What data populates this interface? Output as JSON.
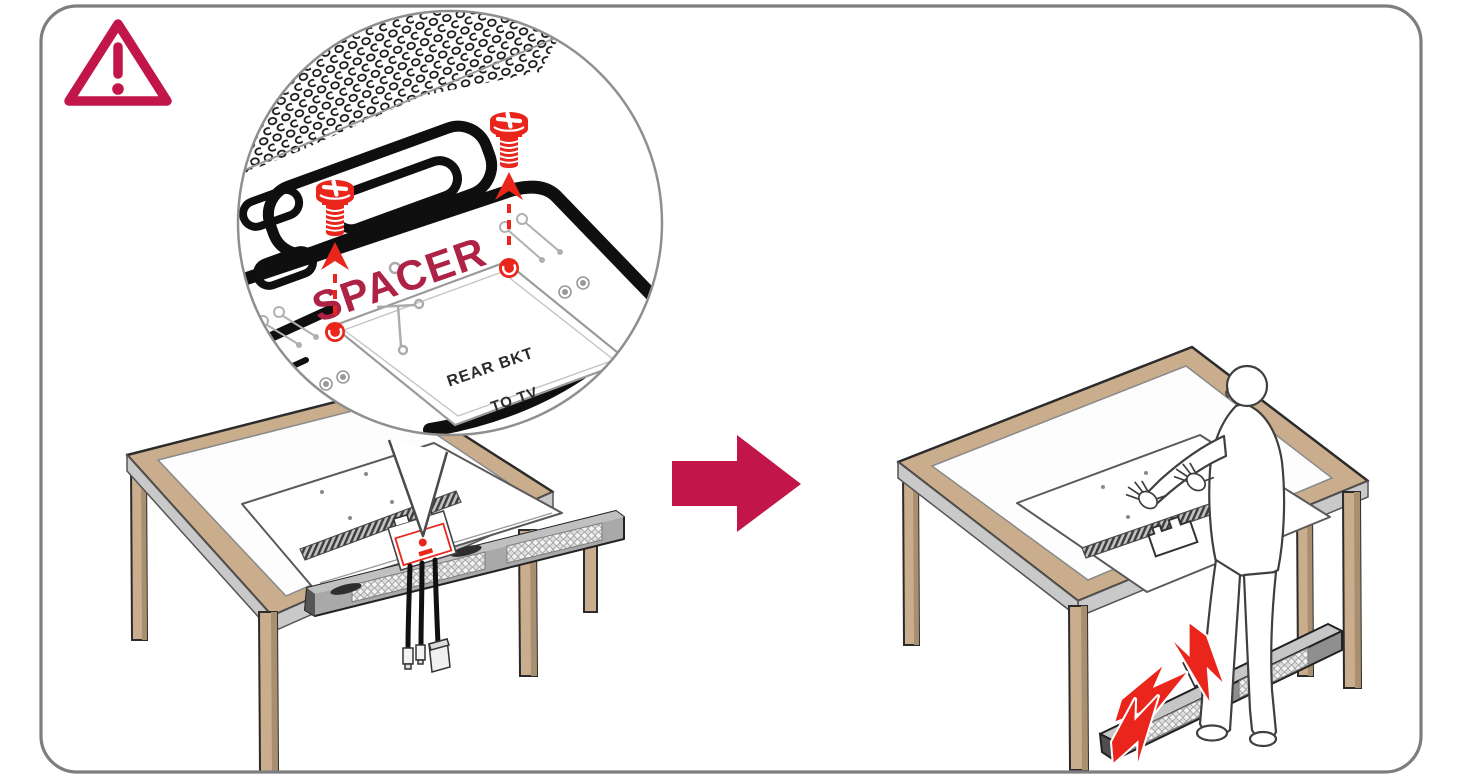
{
  "figure": {
    "type": "tv-soundbar-installation-warning-diagram",
    "magnified_callout": {
      "spacer_label": "SPACER",
      "bracket_label": "REAR BKT",
      "bracket_direction_label": "TO TV"
    },
    "colors": {
      "accent_crimson": "#C2164A",
      "label_crimson": "#AE2246",
      "alert_red": "#E9251C",
      "wood_tan": "#C9AD8C",
      "wood_tan_dark": "#A98F6F",
      "outline_gray": "#8F8F8F"
    },
    "icons": {
      "warning": "warning-triangle-icon",
      "next_step": "arrow-right-icon",
      "fastener": "screw-icon",
      "impact": "impact-bolt-icon"
    }
  }
}
